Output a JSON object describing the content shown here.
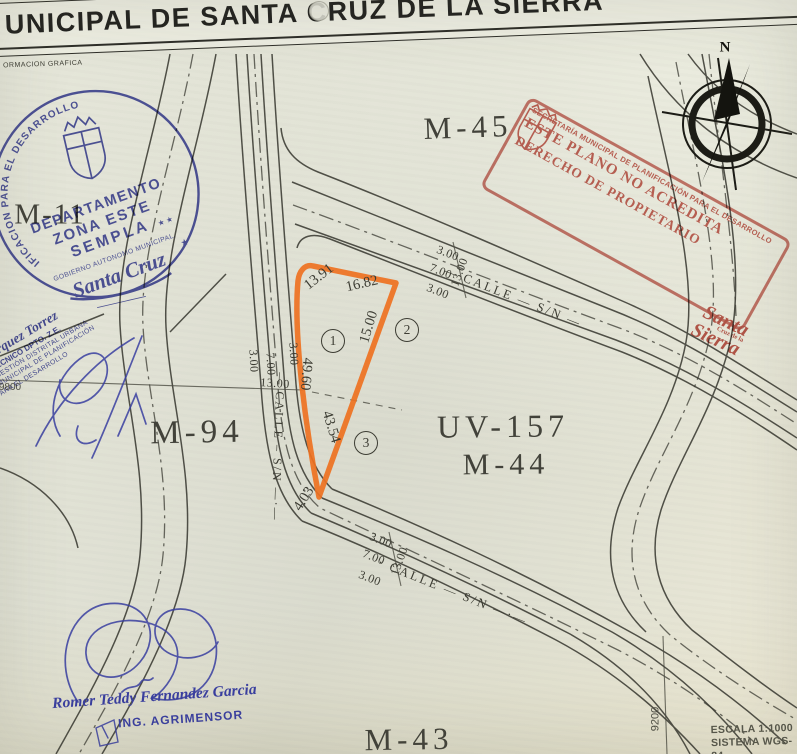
{
  "header": {
    "title": "UNICIPAL DE SANTA CRUZ DE LA SIERRA",
    "subtitle": "ORMACION GRAFICA"
  },
  "compass": {
    "label": "N"
  },
  "blocks": {
    "m45": "M-45",
    "m11": "M-11",
    "m94": "M-94",
    "uv": "UV-157",
    "m44": "M-44",
    "m43": "M-43"
  },
  "parcel": {
    "side_top_left": "13.91",
    "side_top_right": "16.82",
    "side_right_upper": "15.00",
    "side_left": "49.60",
    "side_right_lower": "43.54",
    "side_bottom": "4.03",
    "lots": [
      "1",
      "2",
      "3"
    ]
  },
  "streets": {
    "top": {
      "name": "— CALLE — S/N —",
      "w1": "3.00",
      "w2": "7.00",
      "w3": "3.00",
      "total": "13.00"
    },
    "left": {
      "name": "— CALLE – S/N —·—",
      "w1": "3.00",
      "w2": "7.00",
      "w3": "3.00",
      "total": "13.00"
    },
    "bottom": {
      "name": "· CALLE — S/N —·—",
      "w1": "3.00",
      "w2": "7.00",
      "w3": "3.00",
      "total": "13.00"
    }
  },
  "grid": {
    "east_coord": "9200",
    "west_coord": "9800"
  },
  "scale": {
    "line1": "ESCALA 1:1000",
    "line2": "SISTEMA WGS-84"
  },
  "stamp_blue": {
    "ring": "SECRETARIA MUNICIPAL DE PLANIFICACION PARA EL DESARROLLO",
    "star": "★",
    "dept": "DEPARTAMENTO",
    "zona": "ZONA ESTE",
    "sempla": "SEMPLA",
    "stars": "★ ★",
    "gov": "GOBIERNO AUTONOMO MUNICIPAL.",
    "city": "Santa Cruz"
  },
  "stamp_red": {
    "arc": "SECRETARÍA MUNICIPAL DE PLANIFICACIÓN PARA EL DESARROLLO",
    "line1": "ESTE PLANO NO ACREDITA",
    "line2": "DERECHO DE PROPIETARIO",
    "logo_top": "Santa",
    "logo_mid": "Cruz de la",
    "logo_bottom": "Sierra"
  },
  "stamp_left": {
    "name": "o Bohorquez Torrez",
    "line1": "NTE TÉCNICO   DPTO. Z.E.",
    "line2": "ÓN DE GESTIÓN DISTRITAL URBANA",
    "line3": "TARIA MUNICIPAL DE PLANIFICACIÓN",
    "line4": "PARA EL DESARROLLO"
  },
  "surveyor": {
    "name": "Romer Teddy Fernandez Garcia",
    "title": "ING. AGRIMENSOR"
  },
  "colors": {
    "parcel_orange": "#ee7121",
    "stamp_blue": "#3c42a2",
    "stamp_red": "#c4574d",
    "ink": "#3b3b33"
  }
}
